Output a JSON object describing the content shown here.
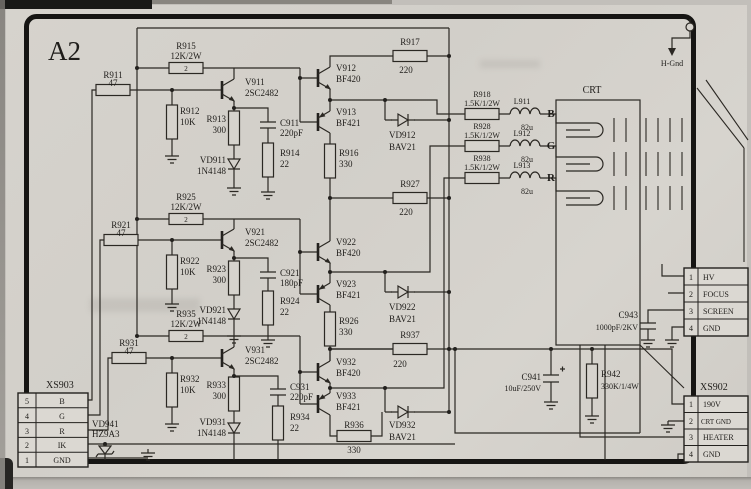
{
  "board": {
    "title": "A2",
    "crt_label": "CRT",
    "h_gnd": "H-Gnd"
  },
  "channels": [
    {
      "sig": "B",
      "r_in": {
        "ref": "R911",
        "val": "47"
      },
      "r_load": {
        "ref": "R915",
        "val": "12K/2W",
        "inner": "2"
      },
      "q1": {
        "ref": "V911",
        "val": "2SC2482"
      },
      "r_base": {
        "ref": "R912",
        "val": "10K"
      },
      "r_e": {
        "ref": "R913",
        "val": "300"
      },
      "d1": {
        "ref": "VD911",
        "val": "1N4148"
      },
      "c1": {
        "ref": "C911",
        "val": "220pF"
      },
      "r_c": {
        "ref": "R914",
        "val": "22"
      },
      "q2": {
        "ref": "V912",
        "val": "BF420"
      },
      "q3": {
        "ref": "V913",
        "val": "BF421"
      },
      "r_e2": {
        "ref": "R916",
        "val": "330"
      },
      "r_top": {
        "ref": "R917",
        "val": "220"
      },
      "d2": {
        "ref": "VD912",
        "val": "BAV21"
      },
      "r_out": {
        "ref": "R918",
        "val": "1.5K/1/2W"
      },
      "l_out": {
        "ref": "L911",
        "val": "82u"
      }
    },
    {
      "sig": "G",
      "r_in": {
        "ref": "R921",
        "val": "47"
      },
      "r_load": {
        "ref": "R925",
        "val": "12K/2W",
        "inner": "2"
      },
      "q1": {
        "ref": "V921",
        "val": "2SC2482"
      },
      "r_base": {
        "ref": "R922",
        "val": "10K"
      },
      "r_e": {
        "ref": "R923",
        "val": "300"
      },
      "d1": {
        "ref": "VD921",
        "val": "1N4148"
      },
      "c1": {
        "ref": "C921",
        "val": "180pF"
      },
      "r_c": {
        "ref": "R924",
        "val": "22"
      },
      "q2": {
        "ref": "V922",
        "val": "BF420"
      },
      "q3": {
        "ref": "V923",
        "val": "BF421"
      },
      "r_e2": {
        "ref": "R926",
        "val": "330"
      },
      "r_top": {
        "ref": "R927",
        "val": "220"
      },
      "d2": {
        "ref": "VD922",
        "val": "BAV21"
      },
      "r_out": {
        "ref": "R928",
        "val": "1.5K/1/2W"
      },
      "l_out": {
        "ref": "L912",
        "val": "82u"
      }
    },
    {
      "sig": "R",
      "r_in": {
        "ref": "R931",
        "val": "47"
      },
      "r_load": {
        "ref": "R935",
        "val": "12K/2W",
        "inner": "2"
      },
      "q1": {
        "ref": "V931",
        "val": "2SC2482"
      },
      "r_base": {
        "ref": "R932",
        "val": "10K"
      },
      "r_e": {
        "ref": "R933",
        "val": "300"
      },
      "d1": {
        "ref": "VD931",
        "val": "1N4148"
      },
      "c1": {
        "ref": "C931",
        "val": "220pF"
      },
      "r_c": {
        "ref": "R934",
        "val": "22"
      },
      "q2": {
        "ref": "V932",
        "val": "BF420"
      },
      "q3": {
        "ref": "V933",
        "val": "BF421"
      },
      "r_e2": {
        "ref": "R936",
        "val": "330"
      },
      "r_top": {
        "ref": "R937",
        "val": "220"
      },
      "d2": {
        "ref": "VD932",
        "val": "BAV21"
      },
      "r_out": {
        "ref": "R938",
        "val": "1.5K/1/2W"
      },
      "l_out": {
        "ref": "L913",
        "val": "82u"
      }
    }
  ],
  "misc": {
    "vd941": {
      "ref": "VD941",
      "val": "HZ9A3"
    },
    "c941": {
      "ref": "C941",
      "val": "10uF/250V"
    },
    "r942": {
      "ref": "R942",
      "val": "330K/1/4W"
    },
    "c943": {
      "ref": "C943",
      "val": "1000pF/2KV"
    }
  },
  "connectors": {
    "xs903": {
      "label": "XS903",
      "pins": [
        {
          "n": "5",
          "label": "B"
        },
        {
          "n": "4",
          "label": "G"
        },
        {
          "n": "3",
          "label": "R"
        },
        {
          "n": "2",
          "label": "IK"
        },
        {
          "n": "1",
          "label": "GND"
        }
      ]
    },
    "crt_socket": {
      "pins": [
        {
          "n": "1",
          "label": "HV"
        },
        {
          "n": "2",
          "label": "FOCUS"
        },
        {
          "n": "3",
          "label": "SCREEN"
        },
        {
          "n": "4",
          "label": "GND"
        }
      ]
    },
    "xs902": {
      "label": "XS902",
      "pins": [
        {
          "n": "1",
          "label": "190V"
        },
        {
          "n": "2",
          "label": "CRT GND"
        },
        {
          "n": "3",
          "label": "HEATER"
        },
        {
          "n": "4",
          "label": "GND"
        }
      ]
    }
  }
}
